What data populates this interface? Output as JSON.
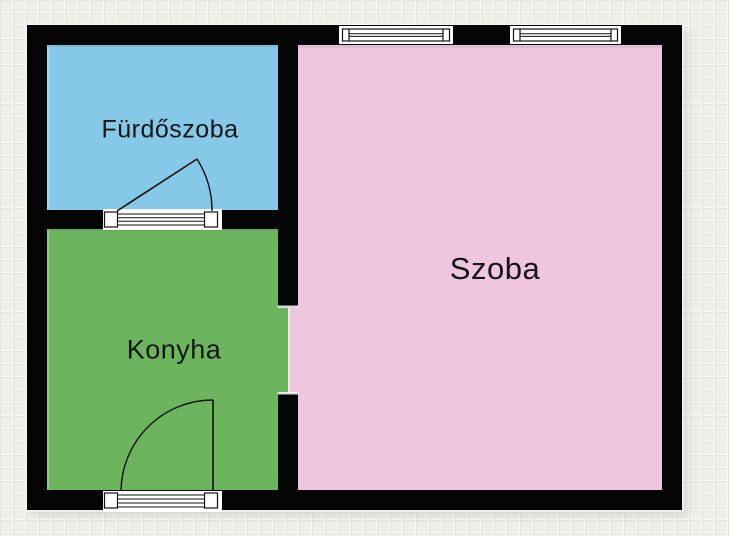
{
  "plan": {
    "title": "Lakás alaprajz",
    "rooms": [
      {
        "id": "furdoszoba",
        "label": "Fürdőszoba",
        "fill": "#85c8e7"
      },
      {
        "id": "konyha",
        "label": "Konyha",
        "fill": "#6db45e"
      },
      {
        "id": "szoba",
        "label": "Szoba",
        "fill": "#eec6df"
      }
    ],
    "fixtures": {
      "windows": [
        {
          "id": "window-1",
          "wall": "top",
          "room": "szoba"
        },
        {
          "id": "window-2",
          "wall": "top",
          "room": "szoba"
        }
      ],
      "doors": [
        {
          "id": "door-furdoszoba",
          "between": [
            "furdoszoba",
            "konyha"
          ],
          "swing": "into-furdoszoba"
        },
        {
          "id": "door-konyha-entry",
          "between": [
            "konyha",
            "exterior"
          ],
          "swing": "into-konyha"
        }
      ],
      "openings": [
        {
          "id": "opening-konyha-szoba",
          "between": [
            "konyha",
            "szoba"
          ]
        }
      ]
    }
  },
  "colors": {
    "background": "#efeee9",
    "grid_line_light": "#fafaf7",
    "grid_line_dark": "#e3e2dd",
    "wall": "#050505",
    "fixture_stroke": "#111111",
    "label_text": "#161616"
  }
}
